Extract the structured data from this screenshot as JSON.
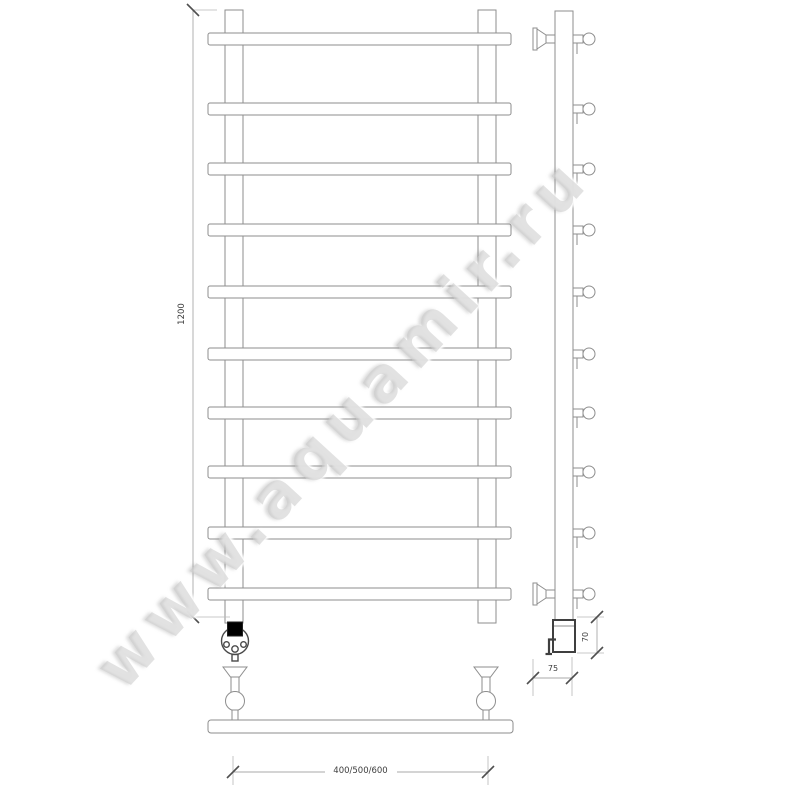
{
  "watermark": {
    "text": "www.aquamir.ru"
  },
  "dimensions": {
    "height": "1200",
    "width_options": "400/500/600",
    "mount_depth": "75",
    "heater_height": "70"
  },
  "colors": {
    "line": "#8e8e8e",
    "dark_line": "#3f3f3f",
    "dim_text": "#3c3c3c",
    "watermark": "#cbcbcb",
    "background": "#ffffff"
  },
  "drawing": {
    "subject": "ladder towel rail technical drawing",
    "rung_count": 10,
    "views": [
      "front",
      "side",
      "bottom"
    ]
  }
}
